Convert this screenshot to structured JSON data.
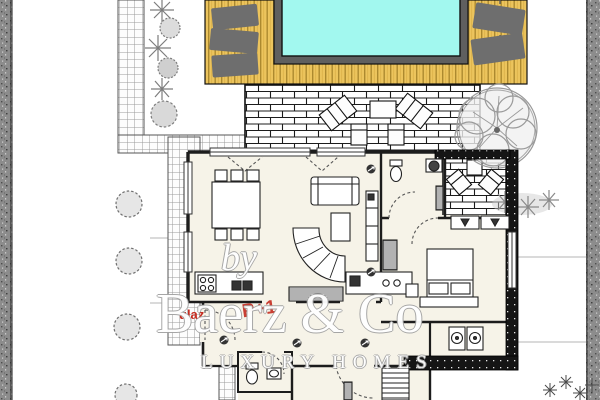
{
  "watermark": {
    "by": "by",
    "brand": "Baerz & Co",
    "tagline": "LUXURY HOMES"
  },
  "labels": {
    "entrance": "ulaz",
    "floor_code": "P+1"
  },
  "colors": {
    "pool_water": "#a2f8ef",
    "pool_rim": "#5f5f5f",
    "deck_wood": "#ecc45d",
    "deck_plank_line": "#8a6a17",
    "lounger_gray": "#6e6e6e",
    "brick_mortar_line": "#1c1c1c",
    "tile_line": "#9a9a9a",
    "wall_black": "#1c1c1c",
    "floor_cream": "#f6f3e8",
    "label_red": "#c52b20",
    "vegetation_gray": "#8f8f8f",
    "road_gray": "#8c8c8c",
    "watermark_white": "#ffffff"
  }
}
